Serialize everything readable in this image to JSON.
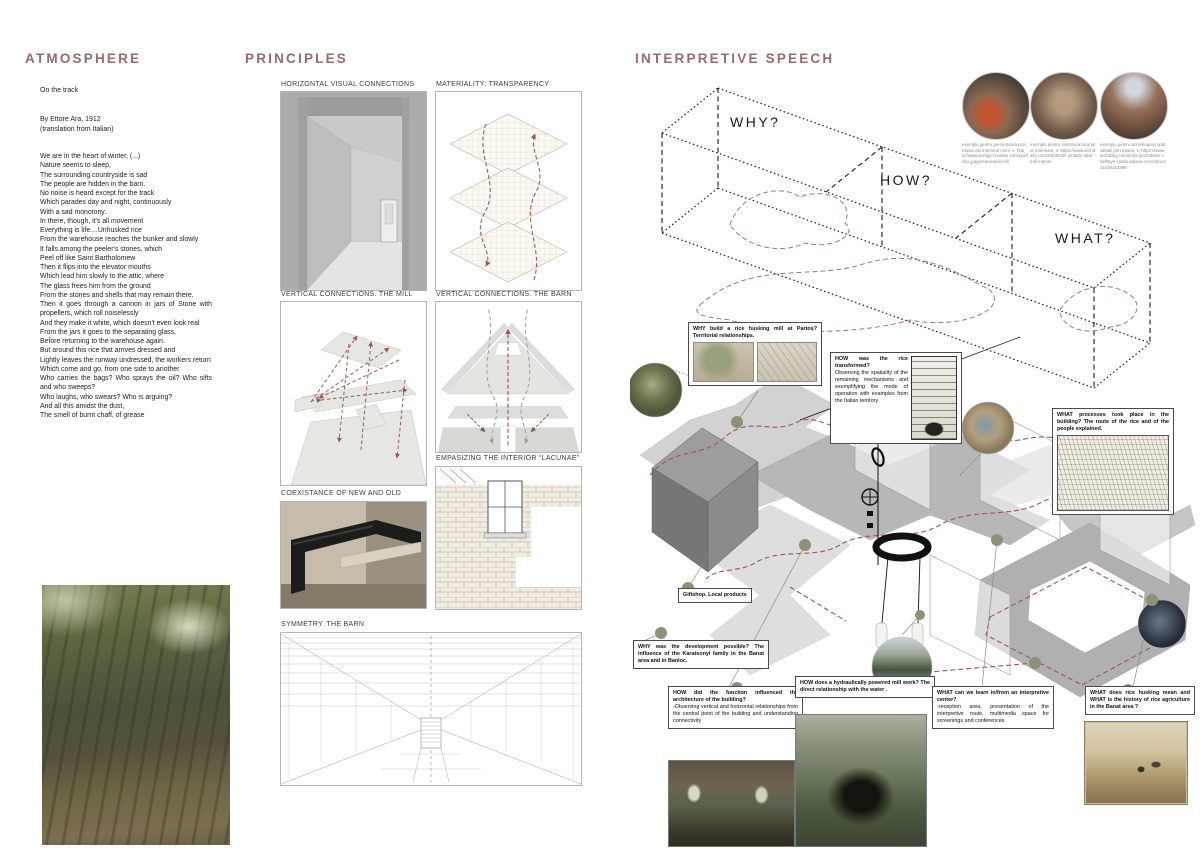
{
  "colors": {
    "accent": "#976b6b",
    "route_red": "#a5544e",
    "ribbon_gray": "#c6c6c6",
    "dot_olive": "#8e9077"
  },
  "atmosphere": {
    "title": "ATMOSPHERE",
    "poem_title": "On the track",
    "byline": "By Ettore Ara, 1912",
    "byline2": "(translation from Italian)",
    "poem": "We are in the heart of winter, (...)\nNature seems to sleep,\nThe surrounding countryside is sad\nThe people are hidden in the barn.\nNo noise is heard except for the track\nWhich parades day and night, continuously\nWith a sad monotony.\nIn there, though, it's all movement\nEverything is life....Unhusked rice\nFrom the warehouse reaches the bunker and slowly\nIt falls among the peeler's stones, which\nPeel off like Saint Bartholomew\nThen it flips into the elevator mouths\nWhich lead him slowly to the attic, where\nThe glass frees him from the ground\nFrom the stones and shells that may remain there.\nThen it goes through a cannon in jars of Stone with propellers, which roll noiselessly\nAnd they make it white, which doesn't even look real\nFrom the jars it goes to the separating glass,\nBefore returning to the warehouse again.\nBut around this rice that arrives dressed and\nLightly leaves the runway undressed, the workers return\nWhich come and go, from one side to another\nWho carries the bags? Who sprays the oil? Who sifts and who sweeps?\nWho laughs, who swears? Who is arguing?\nAnd all this amidst the dust,\nThe smell of burnt chaff, of grease"
  },
  "principles": {
    "title": "PRINCIPLES",
    "panels": {
      "horizontal": "HORIZONTAL VISUAL CONNECTIONS",
      "materiality": "MATERIALITY: TRANSPARENCY",
      "vertical_mill": "VERTICAL  CONNECTIONS. THE MILL",
      "vertical_barn": "VERTICAL CONNECTIONS. THE BARN",
      "coexistance": "COEXISTANCE OF NEW AND OLD",
      "lacunae": "EMPASIZING THE INTERIOR “LACUNAE”",
      "symmetry": "SYMMETRY. THE BARN"
    }
  },
  "interpretive": {
    "title": "INTERPRETIVE SPEECH",
    "zones": {
      "why": "WHY?",
      "how": "HOW?",
      "what": "WHAT?"
    },
    "references": [
      {
        "caption": "exemplu pentru prezentarea proceselor din interiorul morii, s: https://www.vertigo-creative.com/portfolio_page/sacrewell-mill"
      },
      {
        "caption": "exemplu pentru marcarea lacunelor interioare, s: https://www.archdaily.com/200300/el-pintado-tidal-mill-manue"
      },
      {
        "caption": "exemplu pentru accentuarea spatialitatii prin traseu, s: https://www.archdaily.com/en/project/atelier-r-helfstyn-castle-palace-reconstruction/20163398"
      }
    ],
    "annotations": {
      "why_mill": {
        "title": "WHY build a rice husking mill at Partoș? Territorial relationships."
      },
      "how_rice": {
        "title": "HOW was the rice transformed?",
        "body": "Observing the spatiality of the remaining mechanisms and exemplifying the mode of operation with examples from the Italian territory"
      },
      "what_processes": {
        "title": "WHAT processes took place in the building? The route of the rice and of the people explained."
      },
      "giftshop": {
        "title": "Giftshop. Local products"
      },
      "why_development": {
        "title": "WHY was the development possible? The influence of the Karatsonyi family in the Banat area and in Banloc."
      },
      "how_function": {
        "title": "HOW did the function influenced the architecture of the building?",
        "body": "-Observing vertical and horizontal relationships from the central point of the building and understanding connectivity"
      },
      "how_hydraulic": {
        "title": "HOW does a hydraulically powered mill work? The direct relationship with the water ."
      },
      "what_learn": {
        "title": "WHAT can we learn in/from an interpretive center?",
        "body": "-reception area, presentation of the interpretive route, multimedia space for screenings and conferences"
      },
      "what_husking": {
        "title": "WHAT does rice husking mean and WHAT  is the history of rice agriculture in the Banat area ?"
      }
    }
  }
}
